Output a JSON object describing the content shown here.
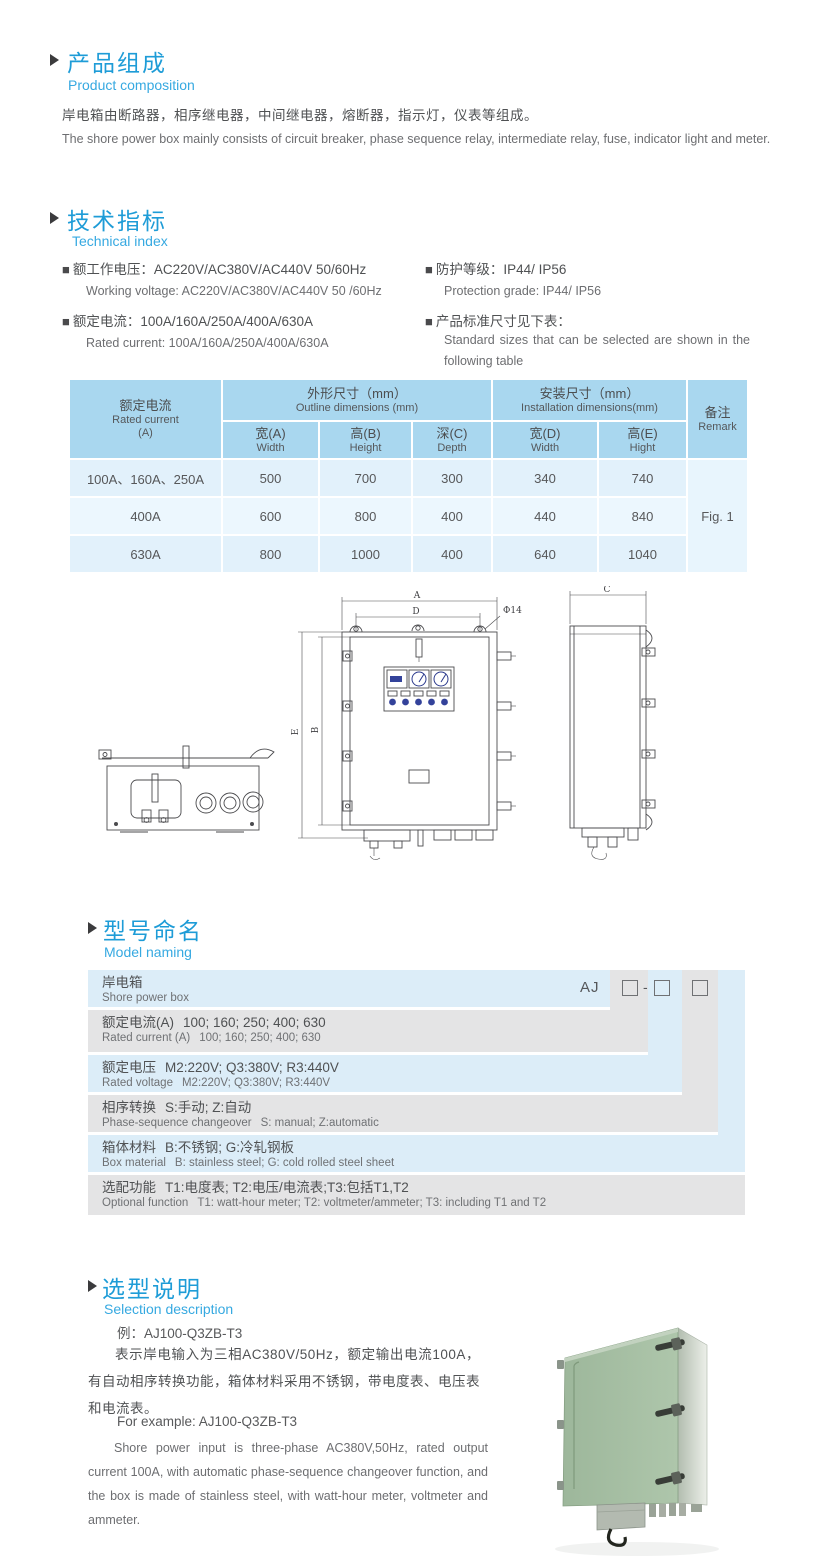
{
  "colors": {
    "accent_blue": "#1e9cd7",
    "subtitle_blue": "#36a9e1",
    "table_header_blue": "#a9d7ef",
    "table_row_blue": "#e2f1fb",
    "naming_row_blue": "#dcedf8",
    "naming_row_gray": "#e4e4e5",
    "photo_green": "#a4bfa1"
  },
  "composition": {
    "title_zh": "产品组成",
    "title_en": "Product  composition",
    "body_zh": "岸电箱由断路器，相序继电器，中间继电器，熔断器，指示灯，仪表等组成。",
    "body_en": "The shore power box mainly consists of circuit breaker, phase sequence relay, intermediate relay, fuse, indicator light and meter."
  },
  "technical": {
    "title_zh": "技术指标",
    "title_en": "Technical index",
    "bullet": "■",
    "items": [
      {
        "zh": "额工作电压：AC220V/AC380V/AC440V  50/60Hz",
        "en": "Working voltage: AC220V/AC380V/AC440V 50 /60Hz"
      },
      {
        "zh": "额定电流：100A/160A/250A/400A/630A",
        "en": "Rated current: 100A/160A/250A/400A/630A"
      },
      {
        "zh": "防护等级：IP44/ IP56",
        "en": "Protection grade: IP44/ IP56"
      },
      {
        "zh": "产品标准尺寸见下表：",
        "en": "Standard sizes that can be selected are shown in the following table"
      }
    ]
  },
  "spec_table": {
    "current_header_zh": "额定电流",
    "current_header_en": "Rated current",
    "current_header_unit": "(A)",
    "outline_zh": "外形尺寸（mm）",
    "outline_en": "Outline dimensions (mm)",
    "install_zh": "安装尺寸（mm）",
    "install_en": "Installation dimensions(mm)",
    "remark_zh": "备注",
    "remark_en": "Remark",
    "sub_headers": [
      {
        "zh": "宽(A)",
        "en": "Width"
      },
      {
        "zh": "高(B)",
        "en": "Height"
      },
      {
        "zh": "深(C)",
        "en": "Depth"
      },
      {
        "zh": "宽(D)",
        "en": "Width"
      },
      {
        "zh": "高(E)",
        "en": "Hight"
      }
    ],
    "rows": [
      {
        "current": "100A、160A、250A",
        "width": "500",
        "height": "700",
        "depth": "300",
        "inst_width": "340",
        "inst_height": "740"
      },
      {
        "current": "400A",
        "width": "600",
        "height": "800",
        "depth": "400",
        "inst_width": "440",
        "inst_height": "840"
      },
      {
        "current": "630A",
        "width": "800",
        "height": "1000",
        "depth": "400",
        "inst_width": "640",
        "inst_height": "1040"
      }
    ],
    "remark_value": "Fig. 1"
  },
  "drawing": {
    "labels": {
      "a": "A",
      "b": "B",
      "c": "C",
      "d": "D",
      "e": "E",
      "phi": "Φ14"
    }
  },
  "naming": {
    "title_zh": "型号命名",
    "title_en": "Model naming",
    "code_prefix": "AJ",
    "code_dash": "-",
    "rows": [
      {
        "zh_label": "岸电箱",
        "zh_value": "",
        "en_label": "Shore power box",
        "en_value": ""
      },
      {
        "zh_label": "额定电流(A)",
        "zh_value": "100; 160; 250; 400; 630",
        "en_label": "Rated current (A)",
        "en_value": "100; 160; 250; 400; 630"
      },
      {
        "zh_label": "额定电压",
        "zh_value": "M2:220V;  Q3:380V;  R3:440V",
        "en_label": "Rated voltage",
        "en_value": "M2:220V;  Q3:380V;  R3:440V"
      },
      {
        "zh_label": "相序转换",
        "zh_value": "S:手动; Z:自动",
        "en_label": "Phase-sequence changeover",
        "en_value": "S: manual;  Z:automatic"
      },
      {
        "zh_label": "箱体材料",
        "zh_value": "B:不锈钢;  G:冷轧钢板",
        "en_label": "Box material",
        "en_value": "B: stainless steel; G: cold rolled steel sheet"
      },
      {
        "zh_label": "选配功能",
        "zh_value": "T1:电度表;  T2:电压/电流表;T3:包括T1,T2",
        "en_label": "Optional function",
        "en_value": "T1: watt-hour meter; T2: voltmeter/ammeter; T3: including T1 and T2"
      }
    ]
  },
  "selection": {
    "title_zh": "选型说明",
    "title_en": "Selection description",
    "example_zh": "例：AJ100-Q3ZB-T3",
    "body_zh": "表示岸电输入为三相AC380V/50Hz，额定输出电流100A，有自动相序转换功能，箱体材料采用不锈钢，带电度表、电压表和电流表。",
    "example_en": "For example: AJ100-Q3ZB-T3",
    "body_en": "Shore power input is three-phase AC380V,50Hz, rated output current 100A, with automatic phase-sequence changeover function, and the box is made of stainless steel, with watt-hour meter, voltmeter and ammeter."
  }
}
